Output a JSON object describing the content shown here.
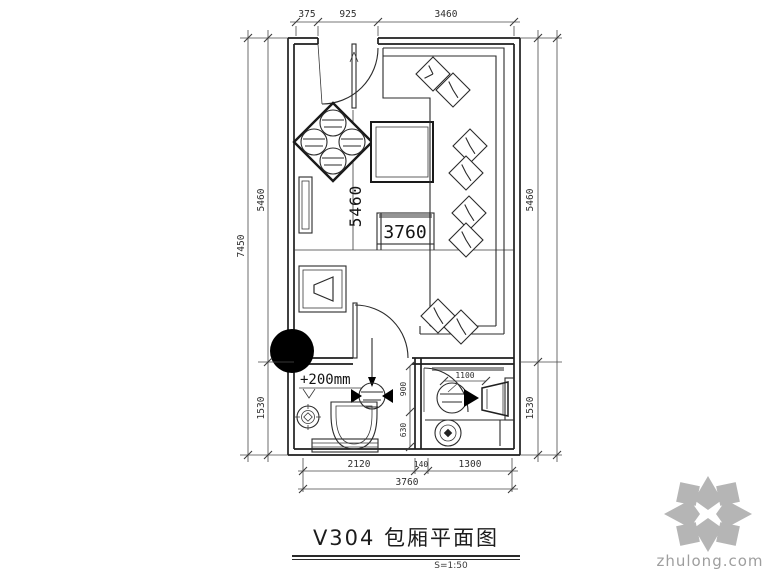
{
  "title": {
    "text": "V304 包厢平面图",
    "scale": "S=1:50"
  },
  "watermark": {
    "brand": "zhulong.com",
    "logo_color": "#b5b5b5",
    "text_color": "#9e9e9e"
  },
  "colors": {
    "line": "#1f1f1f",
    "dimension": "#4a4a4a",
    "gray_fill": "#949494",
    "column_fill": "#000000"
  },
  "dimensions": {
    "top": [
      "375",
      "925",
      "3460"
    ],
    "left_outer": "7450",
    "left_upper": "5460",
    "left_lower": "1530",
    "right_upper": "5460",
    "right_lower": "1530",
    "bottom_row": [
      "2120",
      "140",
      "1300"
    ],
    "bottom_total": "3760",
    "bath_door_width": "1100",
    "bath_split_upper": "900",
    "bath_split_lower": "630"
  },
  "room_labels": {
    "depth": "5460",
    "table_width": "3760",
    "floor_level": "+200mm"
  },
  "symbols": [
    "entry-door-swing",
    "quad-seat-table",
    "wall-console",
    "center-table",
    "side-table-3760",
    "l-sofa",
    "cushion",
    "tv-cabinet",
    "column",
    "bath-door-swing",
    "level-mark",
    "riser-arrow",
    "shower-valve",
    "toilet",
    "floor-drain",
    "drain-rings",
    "washbasin",
    "floor-mat"
  ]
}
